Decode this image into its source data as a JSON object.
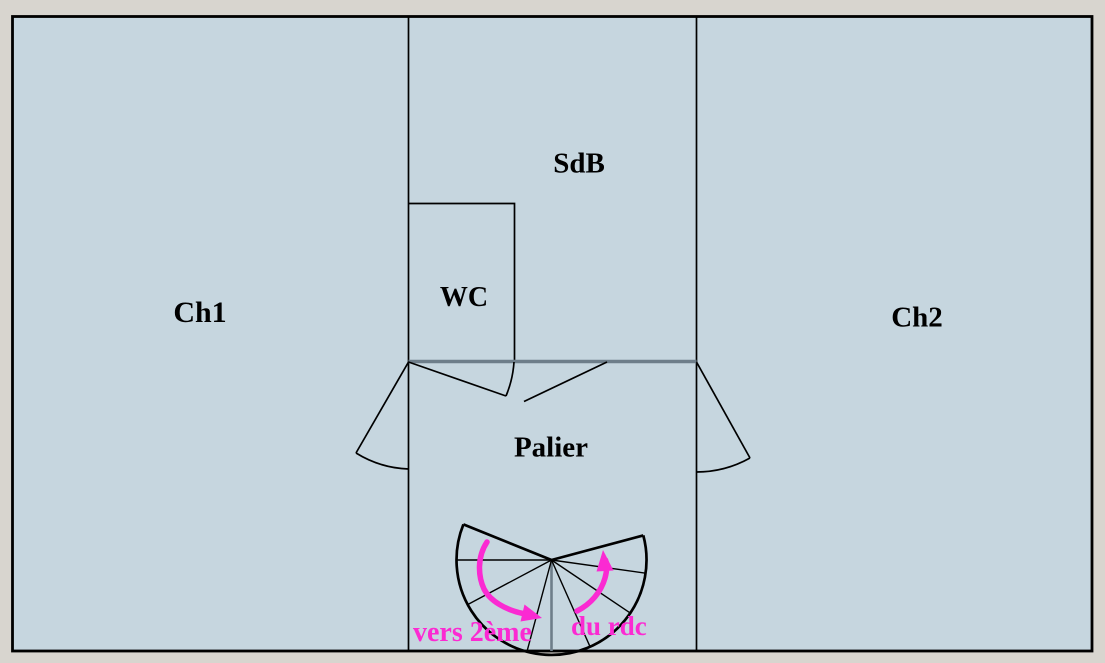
{
  "colors": {
    "page_bg": "#d8d5cf",
    "plan_fill": "#c6d6df",
    "wall": "#000000",
    "partition": "#6e7e8a",
    "annotation": "#fb2ad2"
  },
  "rooms": {
    "ch1": {
      "label": "Ch1"
    },
    "sdb": {
      "label": "SdB"
    },
    "wc": {
      "label": "WC"
    },
    "ch2": {
      "label": "Ch2"
    },
    "palier": {
      "label": "Palier"
    }
  },
  "stairs": {
    "annotations": {
      "up": "vers 2ème",
      "down": "du rdc"
    }
  }
}
